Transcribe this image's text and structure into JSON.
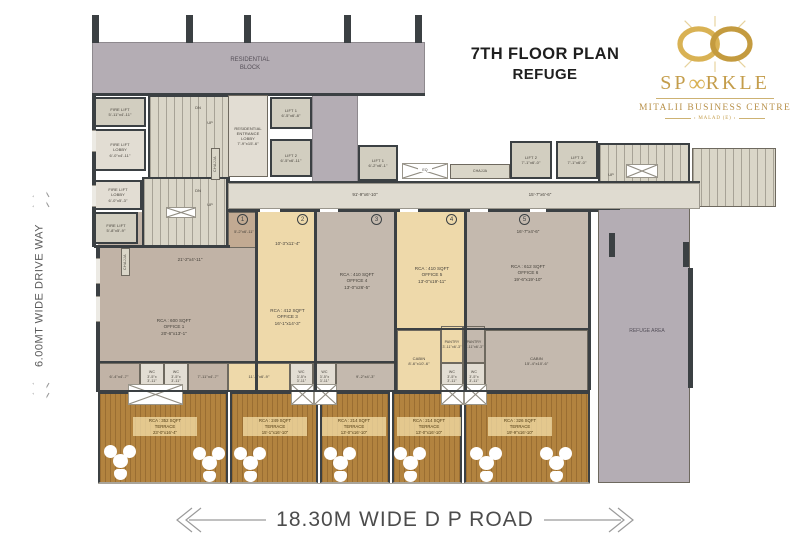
{
  "header": {
    "title_line1": "7TH FLOOR PLAN",
    "title_line2": "REFUGE",
    "brand": {
      "prefix": "SP",
      "symbol": "∞",
      "suffix": "RKLE",
      "subtitle": "MITALII BUSINESS CENTRE",
      "tagline": "MALAD (E)"
    }
  },
  "annotations": {
    "left_road": "6.00MT WIDE DRIVE WAY",
    "bottom_road": "18.30M WIDE D P ROAD"
  },
  "plan": {
    "residential_block": [
      "RESIDENTIAL",
      "BLOCK"
    ],
    "refuge_area": "REFUGE AREA",
    "chajja": "CHAJJA",
    "duct": "EQ",
    "up": "UP",
    "dn": "DN",
    "corridor": {
      "dim_left": "91'-9\"x6'-10\"",
      "dim_right": "15'-7\"x6'-6\""
    },
    "core": {
      "fire_lift_upper": [
        "FIRE LIFT",
        "5'-11\"x4'-11\""
      ],
      "fire_lift_lobby_upper": [
        "FIRE LIFT",
        "LOBBY",
        "6'-0\"x4'-11\""
      ],
      "residential_entrance_lobby": [
        "RESIDENTIAL",
        "ENTRANCE",
        "LOBBY",
        "7'-9\"x15'-6\""
      ],
      "lift_1": [
        "LIFT 1",
        "6'-5\"x6'-8\""
      ],
      "lift_2": [
        "LIFT 2",
        "6'-5\"x6'-11\""
      ],
      "fire_lift_lobby_lower": [
        "FIRE LIFT",
        "LOBBY",
        "6'-0\"x5'-3\""
      ],
      "fire_lift_lower": [
        "FIRE LIFT",
        "5'-8\"x5'-9\""
      ]
    },
    "lifts": {
      "lift_1": [
        "LIFT 1",
        "6'-2\"x6'-1\""
      ],
      "lift_2": [
        "LIFT 2",
        "7'-1\"x6'-0\""
      ],
      "lift_3": [
        "LIFT 3",
        "7'-1\"x6'-0\""
      ]
    },
    "units": [
      {
        "no": "1",
        "top_dim": "5'-2\"x6'-11\"",
        "mid_dim": "21'-2\"x4'-11\"",
        "rca": "RCA : 600 SQFT",
        "name": "OFFICE 1",
        "dim": "20'-6\"x13'-1\""
      },
      {
        "no": "2",
        "top_dim": "10'-3\"x11'-4\"",
        "rca": "RCA : 412 SQFT",
        "name": "OFFICE 3",
        "dim": "16'-1\"x14'-3\""
      },
      {
        "no": "3",
        "rca": "RCA : 410 SQFT",
        "name": "OFFICE 4",
        "dim": "13'-0\"x26'-5\""
      },
      {
        "no": "4",
        "rca": "RCA : 410 SQFT",
        "name": "OFFICE 5",
        "dim": "13'-0\"x19'-11\""
      },
      {
        "no": "5",
        "top_dim": "16'-7\"x4'-6\"",
        "rca": "RCA : 612 SQFT",
        "name": "OFFICE 6",
        "dim": "19'-6\"x19'-10\""
      }
    ],
    "wc": [
      "WC",
      "3'-5\"x",
      "3'-11\""
    ],
    "service_dims": {
      "d1": "6'-4\"x4'-7\"",
      "d2": "7'-11\"x4'-7\"",
      "d3": "11'-0\"x6'-9\"",
      "d4": "9'-2\"x4'-3\""
    },
    "cabin_small": [
      "CABIN",
      "8'-6\"x10'-6\""
    ],
    "cabin_large": [
      "CABIN",
      "15'-4\"x10'-6\""
    ],
    "pantry": [
      "PANTRY",
      "3'-11\"x6'-3\""
    ],
    "terraces": [
      {
        "rca": "RCA : 352 SQFT",
        "name": "TERRACE",
        "dim": "23'-0\"x16'-4\""
      },
      {
        "rca": "RCA : 249 SQFT",
        "name": "TERRACE",
        "dim": "15'-1\"x16'-10\""
      },
      {
        "rca": "RCA : 214 SQFT",
        "name": "TERRACE",
        "dim": "13'-0\"x16'-10\""
      },
      {
        "rca": "RCA : 214 SQFT",
        "name": "TERRACE",
        "dim": "13'-0\"x16'-10\""
      },
      {
        "rca": "RCA : 326 SQFT",
        "name": "TERRACE",
        "dim": "19'-9\"x16'-10\""
      }
    ]
  },
  "colors": {
    "gold": "#c49d4b",
    "wall": "#3b4043",
    "residential_mauve": "#b4adb4",
    "office_cream": "#eed9aa",
    "office_taupe": "#c1b3a6",
    "stair_beige": "#dad6c8",
    "terrace_wood": "#b2833f",
    "corridor": "#dfdbd0"
  }
}
